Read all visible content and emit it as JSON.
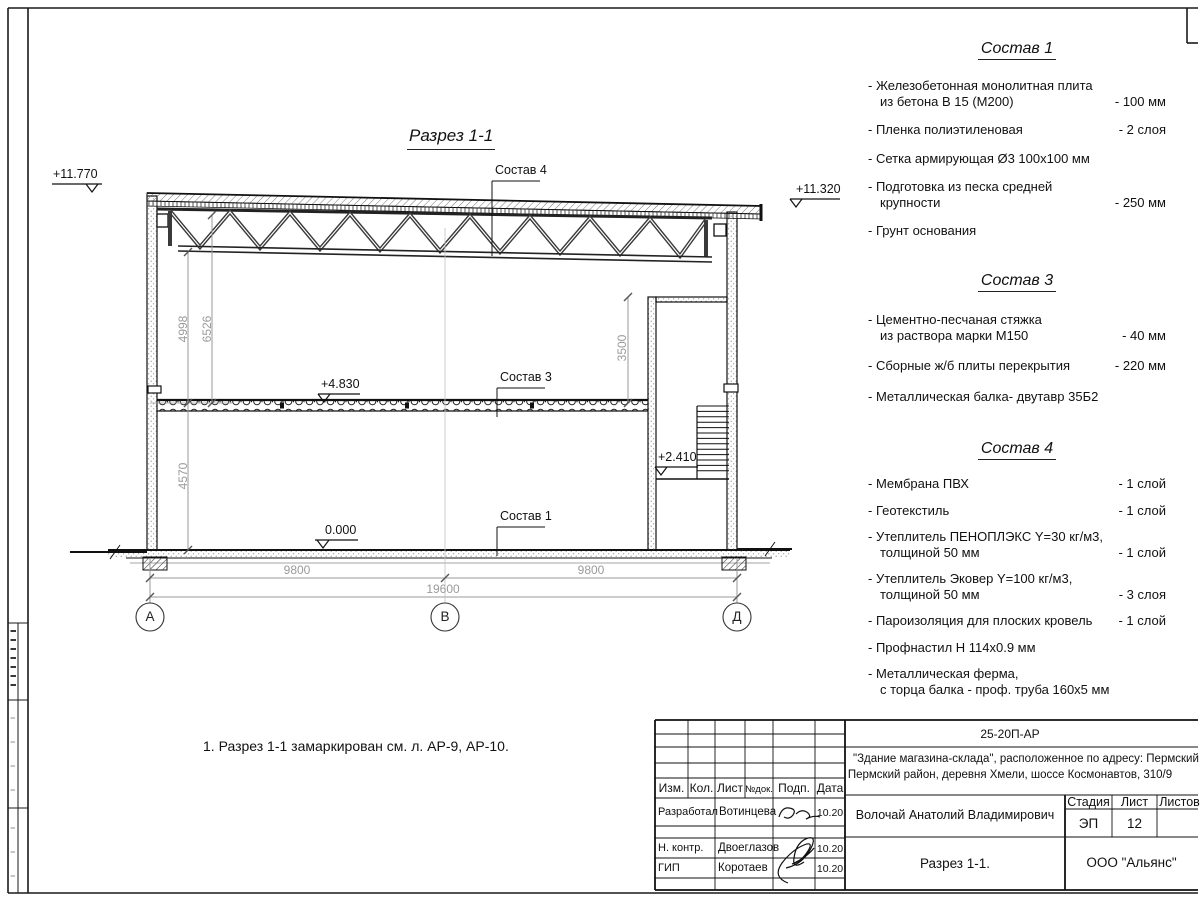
{
  "colors": {
    "paper": "#ffffff",
    "line": "#1a1a1a",
    "dim_text": "#9a9a9a"
  },
  "drawing": {
    "title": "Разрез 1-1",
    "note": "1. Разрез 1-1 замаркирован см. л. АР-9, АР-10.",
    "labels": {
      "sostav4": "Состав 4",
      "sostav3": "Состав 3",
      "sostav1": "Состав 1"
    },
    "elevations": {
      "top_left": "+11.770",
      "top_right": "+11.320",
      "slab": "+4.830",
      "landing": "+2.410",
      "ground": "0.000"
    },
    "dims": {
      "v_truss": "4998",
      "v_roof": "6526",
      "v_lower": "4570",
      "v_room": "3500",
      "span_left": "9800",
      "span_right": "9800",
      "total": "19600"
    },
    "axes": [
      "А",
      "В",
      "Д"
    ]
  },
  "panel": {
    "sections": [
      {
        "title": "Состав 1",
        "items": [
          {
            "name": "- Железобетонная  монолитная плита\nиз бетона В 15 (М200)",
            "value": "- 100 мм"
          },
          {
            "name": "- Пленка полиэтиленовая",
            "value": "-  2 слоя"
          },
          {
            "name": "- Сетка армирующая Ø3 100х100 мм",
            "value": ""
          },
          {
            "name": "- Подготовка из песка средней\nкрупности",
            "value": "- 250 мм"
          },
          {
            "name": "- Грунт основания",
            "value": ""
          }
        ]
      },
      {
        "title": "Состав 3",
        "items": [
          {
            "name": "- Цементно-песчаная стяжка\nиз раствора марки М150",
            "value": "- 40 мм"
          },
          {
            "name": "- Сборные ж/б плиты перекрытия",
            "value": "- 220 мм"
          },
          {
            "name": "- Металлическая балка- двутавр 35Б2",
            "value": ""
          }
        ]
      },
      {
        "title": "Состав 4",
        "items": [
          {
            "name": "- Мембрана ПВХ",
            "value": "- 1 слой"
          },
          {
            "name": "- Геотекстиль",
            "value": "- 1 слой"
          },
          {
            "name": "- Утеплитель ПЕНОПЛЭКС Y=30 кг/м3,\nтолщиной 50 мм",
            "value": "- 1 слой"
          },
          {
            "name": "- Утеплитель Эковер Y=100 кг/м3,\nтолщиной 50 мм",
            "value": "- 3 слоя"
          },
          {
            "name": "- Пароизоляция для плоских кровель",
            "value": "- 1 слой"
          },
          {
            "name": "- Профнастил Н 114х0.9 мм",
            "value": ""
          },
          {
            "name": "- Металлическая ферма,\nс торца балка - проф. труба 160х5 мм",
            "value": ""
          }
        ]
      }
    ]
  },
  "titleblock": {
    "code": "25-20П-АР",
    "project_line1": "\"Здание магазина-склада\", расположенное по адресу: Пермский край,",
    "project_line2": "Пермский район, деревня Хмели, шоссе Космонавтов, 310/9",
    "cols": {
      "izm": "Изм.",
      "kol": "Кол.",
      "list": "Лист",
      "ndok": "№док.",
      "podp": "Подп.",
      "data": "Дата"
    },
    "rows": [
      {
        "role": "Разработал",
        "name": "Вотинцева",
        "date": "10.20"
      },
      {
        "role": "Н. контр.",
        "name": "Двоеглазов",
        "date": "10.20"
      },
      {
        "role": "ГИП",
        "name": "Коротаев",
        "date": "10.20"
      }
    ],
    "author": "Волочай Анатолий Владимирович",
    "stage_label": "Стадия",
    "sheet_label": "Лист",
    "sheets_label": "Листов",
    "stage": "ЭП",
    "sheet": "12",
    "doc_title": "Разрез 1-1.",
    "company": "ООО \"Альянс\""
  }
}
